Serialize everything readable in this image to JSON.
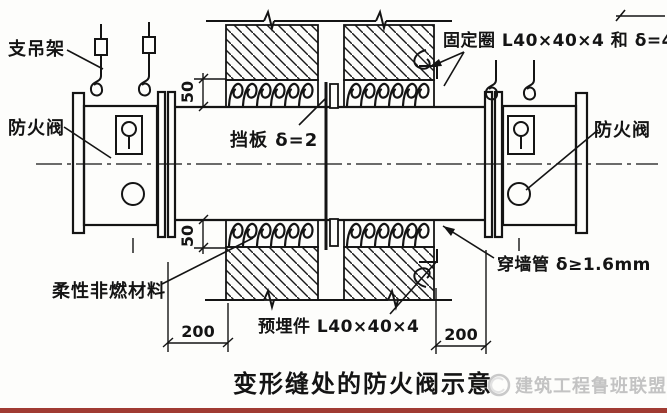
{
  "diagram": {
    "labels": {
      "hanger": "支吊架",
      "fire_damper_left": "防火阀",
      "fire_damper_right": "防火阀",
      "fixing_ring": "固定圈 L40×40×4 和 δ=4",
      "baffle": "挡板 δ=2",
      "flexible_material": "柔性非燃材料",
      "embedded_part": "预埋件 L40×40×4",
      "wall_sleeve": "穿墙管 δ≥1.6mm"
    },
    "dimensions": {
      "coil_top": "50",
      "coil_bottom": "50",
      "wall_left": "200",
      "wall_right": "200"
    },
    "title": "变形缝处的防火阀示意",
    "watermark": "建筑工程鲁班联盟",
    "colors": {
      "line": "#1a1a1a",
      "watermark": "#c3c3c3",
      "bottom_bar": "#a03b32"
    }
  }
}
